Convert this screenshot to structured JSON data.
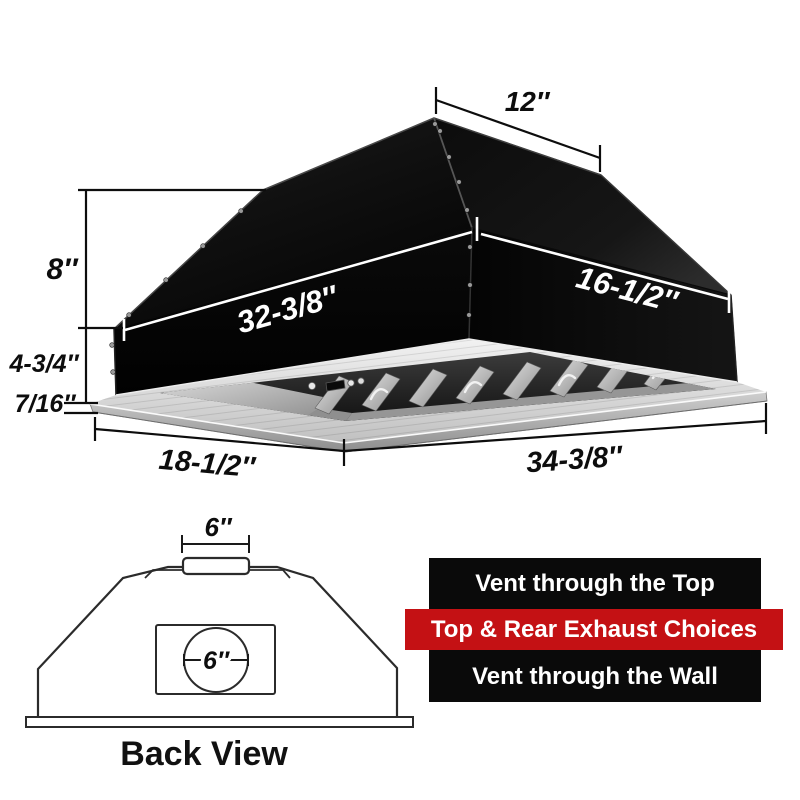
{
  "hood": {
    "dims": {
      "top_depth": "12″",
      "upper_height": "8″",
      "front_width": "32-3/8″",
      "side_depth": "16-1/2″",
      "lower_height": "4-3/4″",
      "flange_thickness": "7/16″",
      "bottom_depth": "18-1/2″",
      "bottom_width": "34-3/8″"
    }
  },
  "back_view": {
    "caption": "Back View",
    "top_vent_width": "6″",
    "rear_vent_diameter": "6″"
  },
  "banners": {
    "top_label": "Vent through the Top",
    "middle_label": "Top & Rear Exhaust Choices",
    "bottom_label": "Vent through the Wall"
  },
  "colors": {
    "banner_black": "#0a0a0a",
    "banner_red": "#c41114",
    "banner_text": "#ffffff",
    "hood_body": "#0b0b0b",
    "steel": "#d9d9d9"
  }
}
